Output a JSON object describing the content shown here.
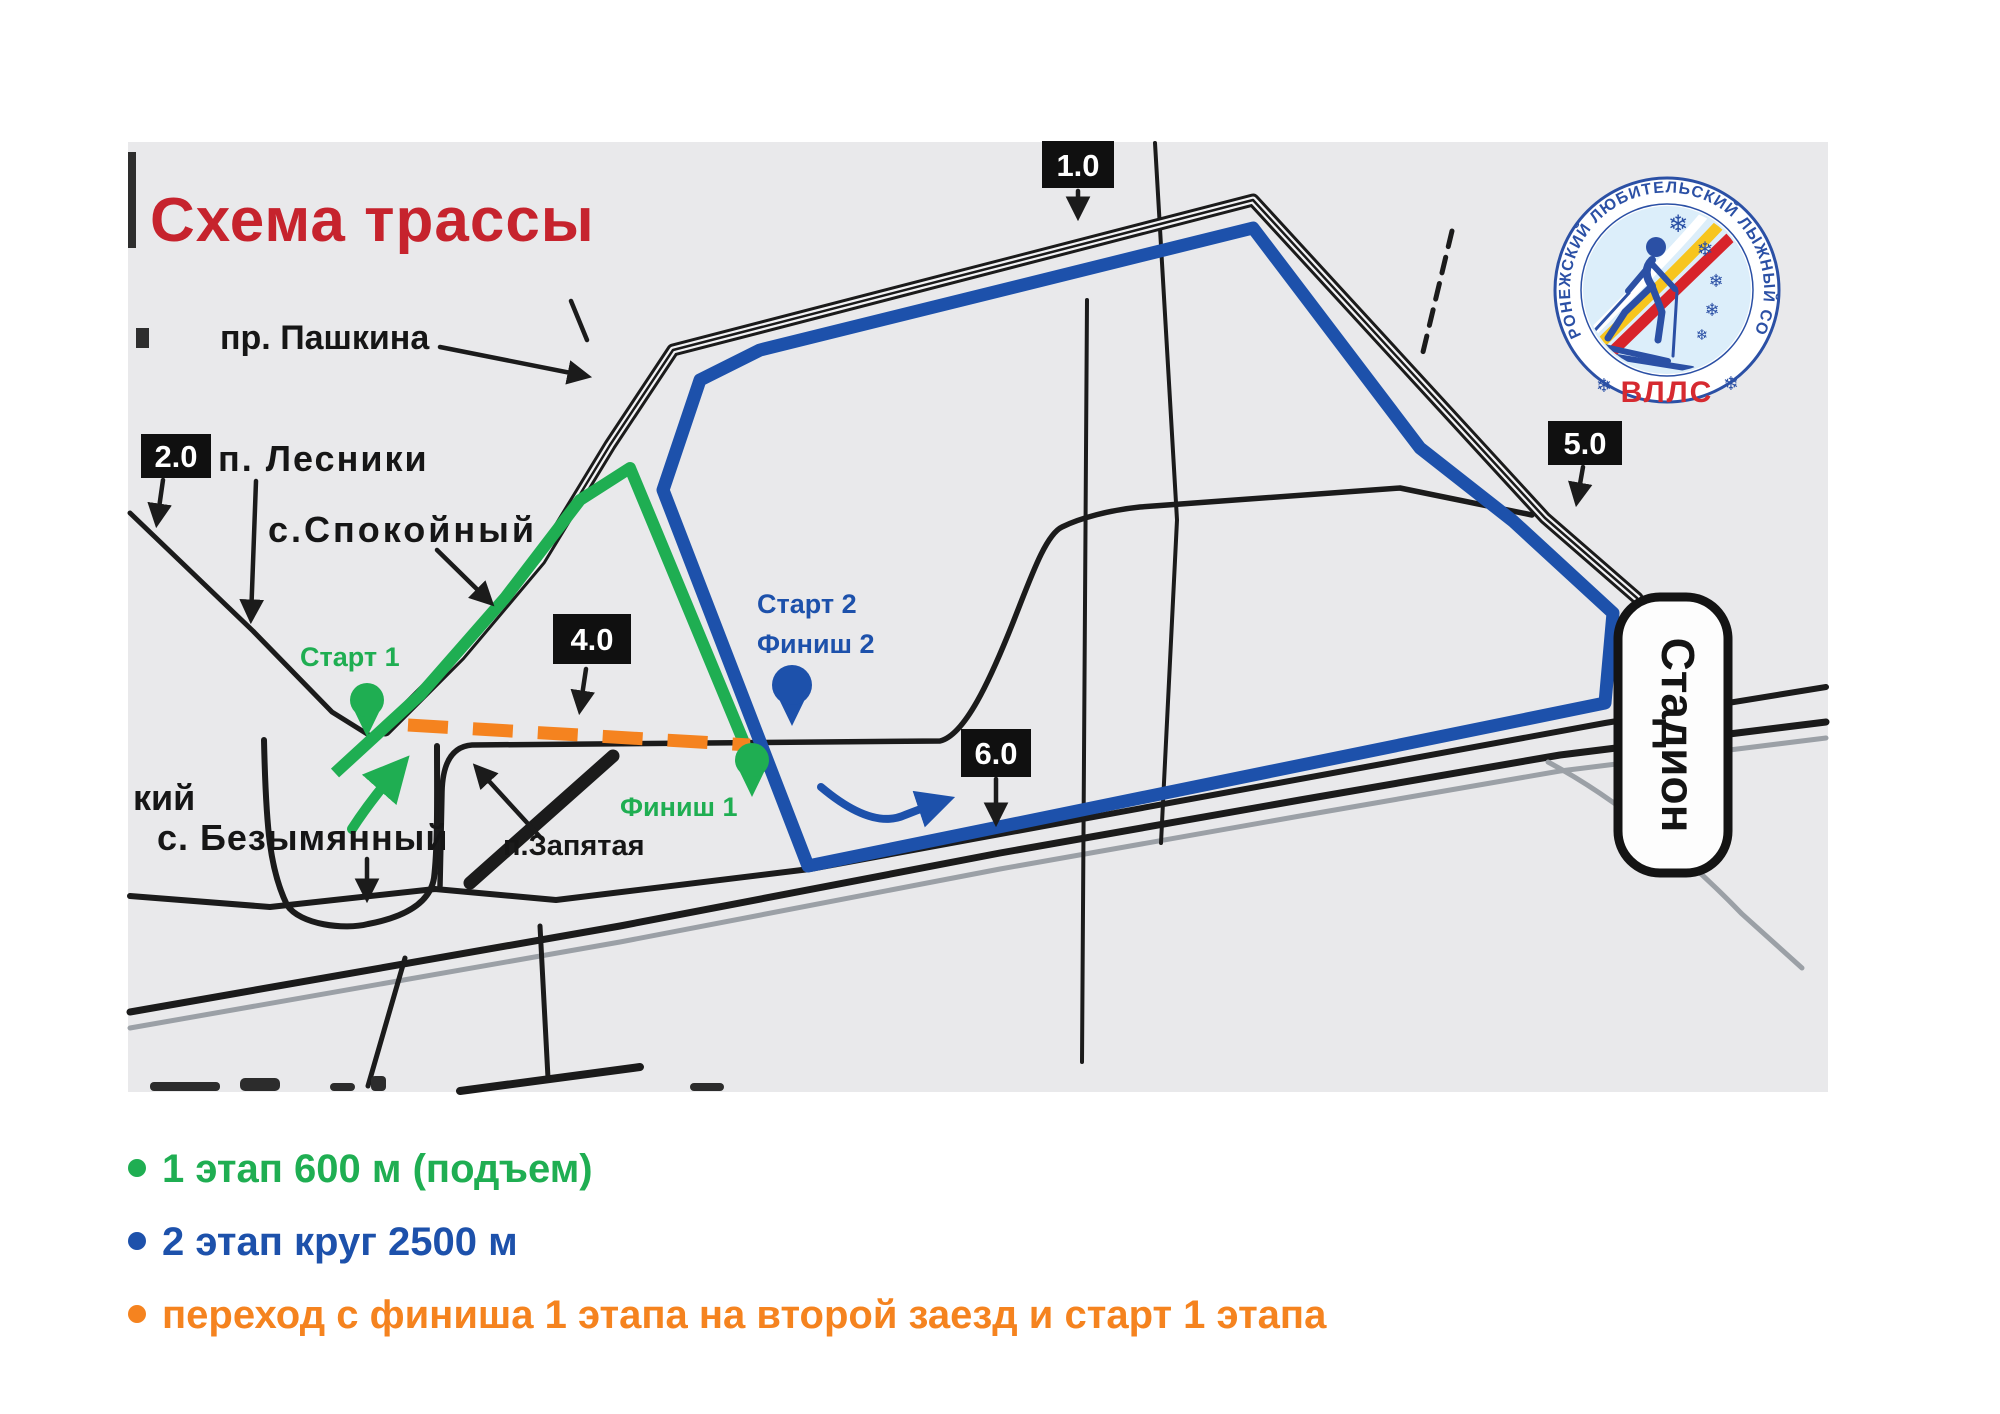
{
  "title": "Схема трассы",
  "map": {
    "labels": {
      "pashkina": "пр. Пашкина",
      "lesniki": "п. Лесники",
      "spokoyny": "с.Спокойный",
      "start1": "Старт 1",
      "start2": "Старт 2",
      "finish2": "Финиш 2",
      "finish1": "Финиш 1",
      "bezymyanny_fragment": "кий",
      "bezymyanny": "с. Безымянный",
      "zapyataya": "п.Запятая",
      "stadium": "Стадион"
    },
    "markers": {
      "m10": "1.0",
      "m20": "2.0",
      "m40": "4.0",
      "m50": "5.0",
      "m60": "6.0"
    }
  },
  "logo": {
    "ring_text": "ВОРОНЕЖСКИЙ ЛЮБИТЕЛЬСКИЙ ЛЫЖНЫЙ СОЮЗ",
    "abbr": "ВЛЛС",
    "snowflake": "❄"
  },
  "legend": {
    "items": [
      {
        "text": "1 этап 600 м (подъем)",
        "color": "#1fae52"
      },
      {
        "text": "2 этап круг 2500 м",
        "color": "#1d51ab"
      },
      {
        "text": "переход с финиша 1 этапа на второй заезд и старт 1 этапа",
        "color": "#f5831f"
      }
    ]
  },
  "colors": {
    "route_green": "#1fae52",
    "route_blue": "#1d51ab",
    "transition_orange": "#f5831f",
    "title_red": "#c6232d",
    "map_background": "#e9e9eb"
  }
}
